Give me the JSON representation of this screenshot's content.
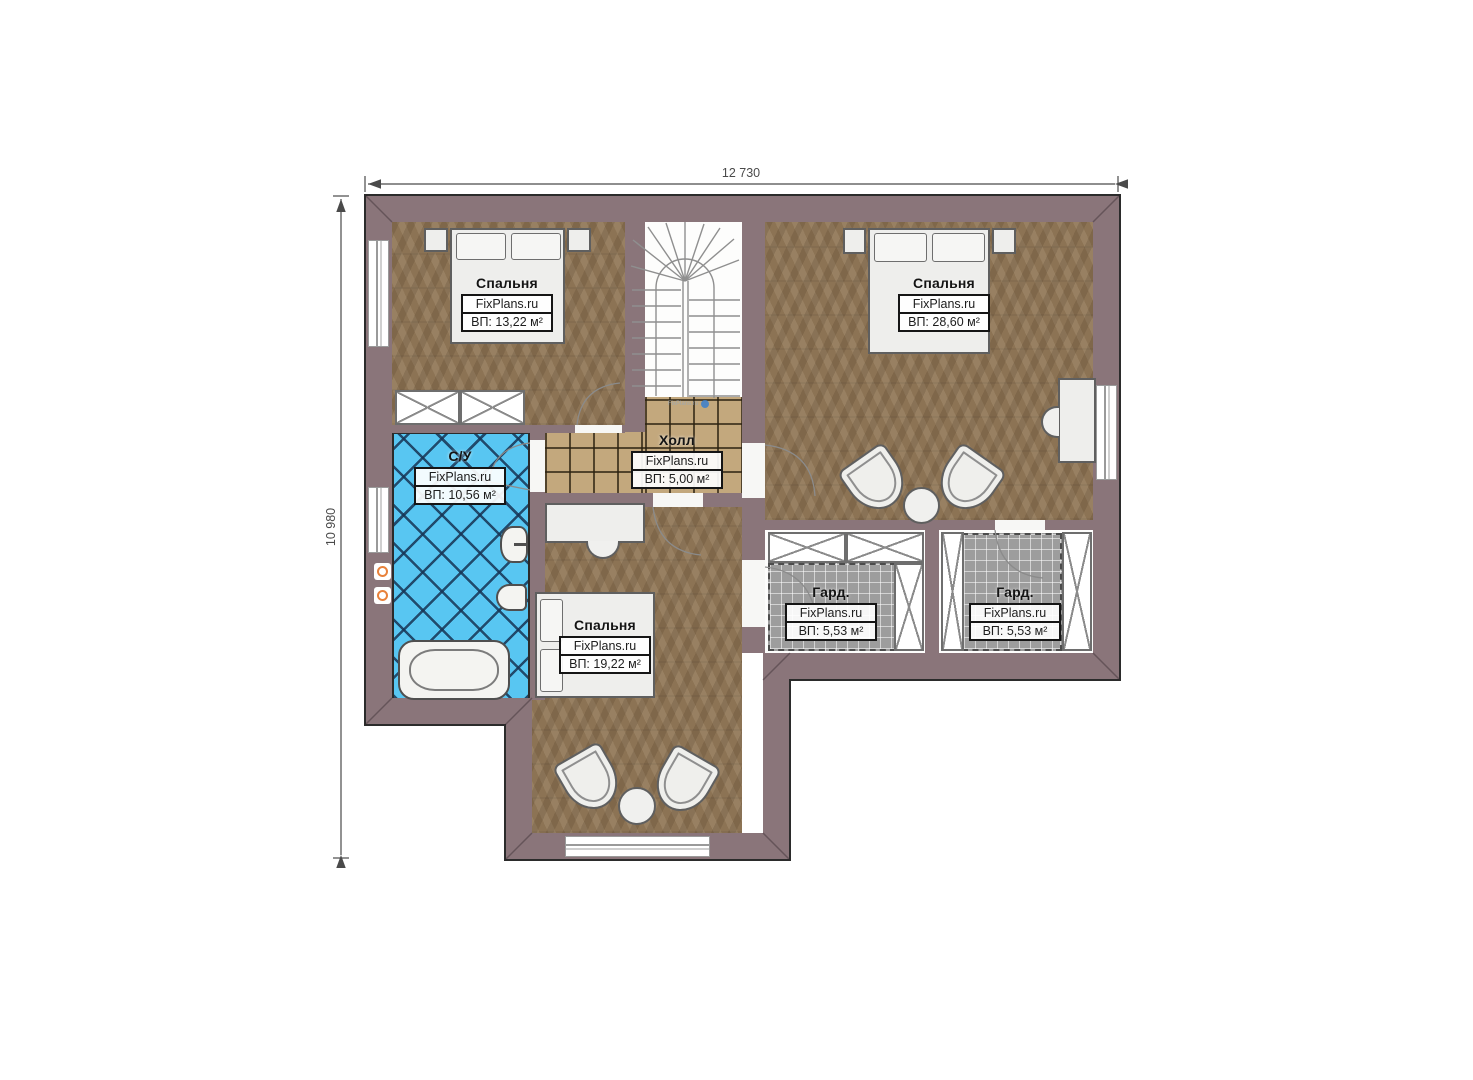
{
  "watermark_brand": "FixPlans.ru",
  "dimensions": {
    "width": "12 730",
    "height": "10 980"
  },
  "rooms": [
    {
      "id": "bedroom-top-left",
      "name": "Спальня",
      "brand": "FixPlans.ru",
      "area": "ВП: 13,22 м²"
    },
    {
      "id": "bedroom-top-right",
      "name": "Спальня",
      "brand": "FixPlans.ru",
      "area": "ВП: 28,60 м²"
    },
    {
      "id": "hall",
      "name": "Холл",
      "brand": "FixPlans.ru",
      "area": "ВП: 5,00 м²"
    },
    {
      "id": "bathroom",
      "name": "С/У",
      "brand": "FixPlans.ru",
      "area": "ВП: 10,56 м²"
    },
    {
      "id": "bedroom-bottom",
      "name": "Спальня",
      "brand": "FixPlans.ru",
      "area": "ВП: 19,22 м²"
    },
    {
      "id": "wardrobe-left",
      "name": "Гард.",
      "brand": "FixPlans.ru",
      "area": "ВП: 5,53 м²"
    },
    {
      "id": "wardrobe-right",
      "name": "Гард.",
      "brand": "FixPlans.ru",
      "area": "ВП: 5,53 м²"
    }
  ],
  "colors": {
    "wall": "#8a757a",
    "parquet": "#8c7354",
    "hall_tile": "#c3a87d",
    "bath_tile": "#58c6f2",
    "carpet": "#9d9d9d",
    "watermark_dot": "#3a80cf",
    "pipe_orange": "#e8813a"
  }
}
